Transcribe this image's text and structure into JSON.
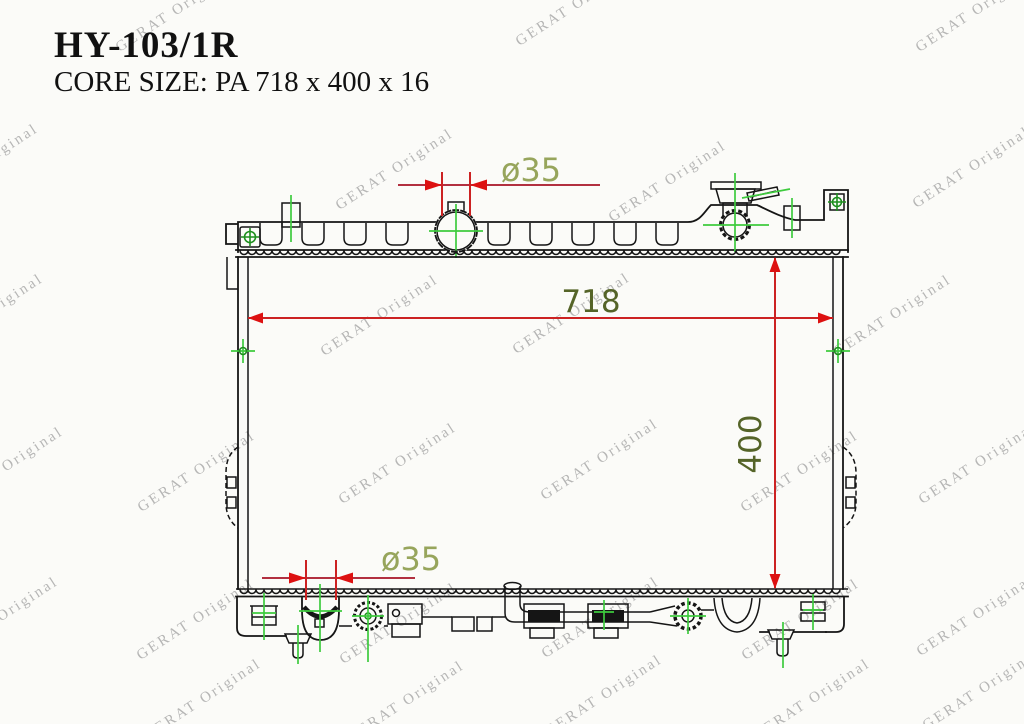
{
  "header": {
    "title": "HY-103/1R",
    "subtitle": "CORE SIZE: PA 718 x 400 x 16"
  },
  "watermark": {
    "text": "GERAT Original",
    "color": "#aaaaaa"
  },
  "drawing": {
    "part": "radiator-technical-drawing-side-view",
    "dim_width": "718",
    "dim_height": "400",
    "dim_top_port": "ø35",
    "dim_bottom_port": "ø35",
    "colors": {
      "outline": "#151515",
      "dimension": "#cc2222",
      "dimension_line": "#b23040",
      "arrow": "#dd1111",
      "dim_text": "#556428",
      "port_text": "#97a55c",
      "centerline": "#3ecb3e",
      "centerline_dark": "#1e8f1e",
      "watermark": "#aaaaaa"
    }
  }
}
